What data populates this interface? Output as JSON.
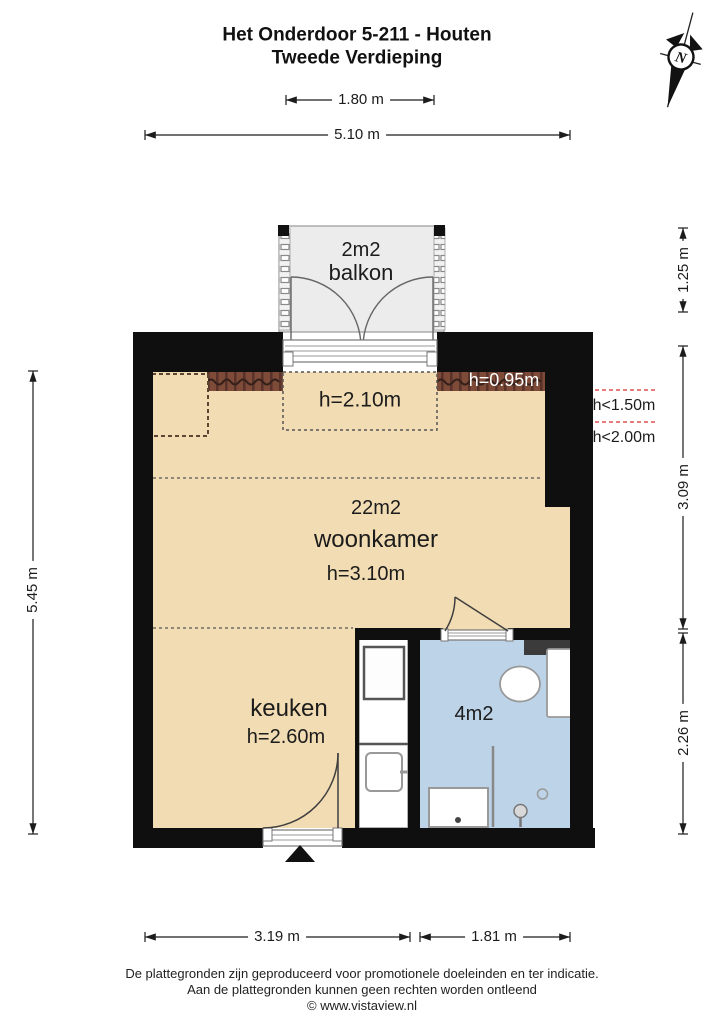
{
  "title": {
    "line1": "Het Onderdoor 5-211 - Houten",
    "line2": "Tweede Verdieping"
  },
  "compass": {
    "label": "N"
  },
  "dimensions": {
    "balcony_width": "1.80 m",
    "total_width": "5.10 m",
    "total_depth": "5.45 m",
    "balcony_depth": "1.25 m",
    "living_depth": "3.09 m",
    "kitchen_depth": "2.26 m",
    "bottom_left_width": "3.19 m",
    "bottom_right_width": "1.81 m"
  },
  "rooms": {
    "balcony": {
      "area": "2m2",
      "name": "balkon"
    },
    "living_room": {
      "area": "22m2",
      "name": "woonkamer",
      "ceiling_height": "h=3.10m"
    },
    "kitchen": {
      "name": "keuken",
      "ceiling_height": "h=2.60m"
    },
    "bathroom": {
      "area": "4m2"
    },
    "dormer_zone": {
      "ceiling_height": "h=2.10m"
    },
    "knee_wall": {
      "ceiling_height": "h=0.95m"
    }
  },
  "slope_annotations": {
    "line1": "h<1.50m",
    "line2": "h<2.00m"
  },
  "footer": {
    "line1": "De plattegronden zijn geproduceerd voor promotionele doeleinden en ter indicatie.",
    "line2": "Aan de plattegronden kunnen geen rechten worden ontleend",
    "line3": "© www.vistaview.nl"
  },
  "colors": {
    "floor": "#f2dcb3",
    "bathroom_floor": "#bdd3e8",
    "balcony_floor": "#ececec",
    "roof_strip": "#7d4b38",
    "wall": "#0f0f0f",
    "slope_line": "#e87b7b"
  }
}
